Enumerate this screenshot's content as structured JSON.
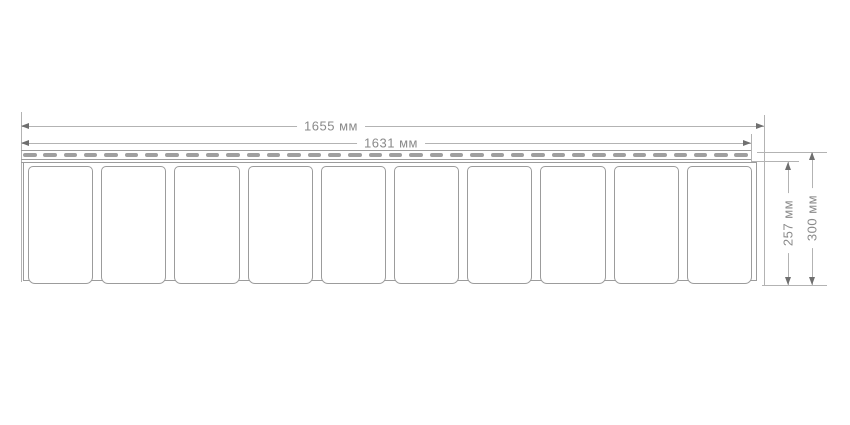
{
  "drawing": {
    "type": "siding-panel-front-view-technical-drawing",
    "dimensions": {
      "width_outer": {
        "label": "1655 мм"
      },
      "width_inner": {
        "label": "1631 мм"
      },
      "height_inner": {
        "label": "257 мм"
      },
      "height_outer": {
        "label": "300 мм"
      }
    },
    "panel": {
      "shake_count": 10,
      "perforation_count": 36
    },
    "colors": {
      "background": "#ffffff",
      "line": "#b3b3b3",
      "outline": "#9c9c9c",
      "arrow": "#6f6f6f",
      "text": "#8a8a8a",
      "perforation": "#9f9f9f"
    }
  }
}
